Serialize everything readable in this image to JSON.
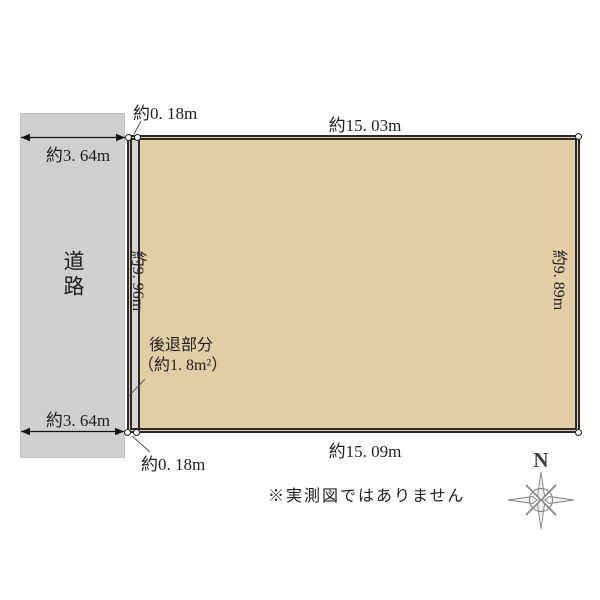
{
  "road": {
    "label": "道路",
    "width_top": "約3. 64m",
    "width_bottom": "約3. 64m"
  },
  "plot": {
    "top_length": "約15. 03m",
    "bottom_length": "約15. 09m",
    "left_length": "約9. 96m",
    "right_length": "約9. 89m"
  },
  "setback": {
    "width_top": "約0. 18m",
    "width_bottom": "約0. 18m",
    "note_line1": "後退部分",
    "note_line2": "（約1. 8m²）"
  },
  "footnote": "※実測図ではありません",
  "compass": {
    "north_label": "N"
  },
  "colors": {
    "plot_fill": "#e2cda4",
    "road_fill": "#cfcfcf",
    "setback_fill": "#d6d6d6",
    "boundary_line": "#2b2b2b",
    "text": "#1f1f1f",
    "compass": "#8a8a8a"
  }
}
